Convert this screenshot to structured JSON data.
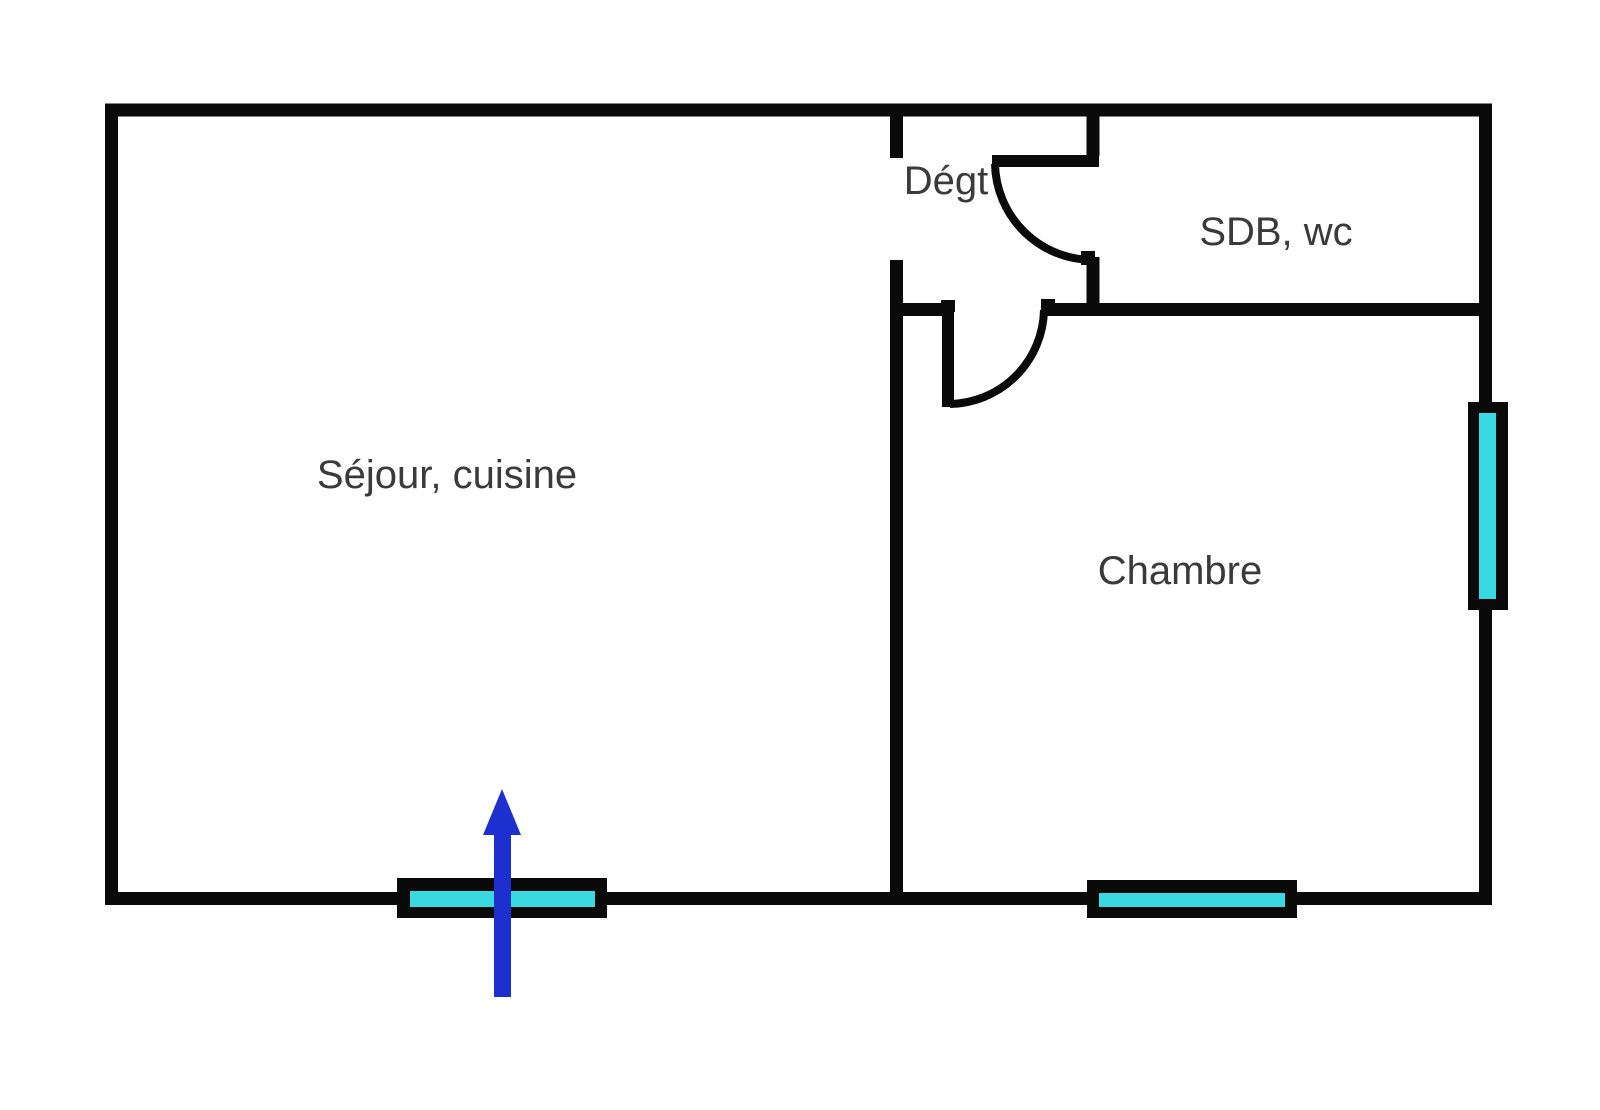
{
  "floor_plan": {
    "rooms": [
      {
        "id": "sejour-cuisine",
        "label": "Séjour, cuisine"
      },
      {
        "id": "degagement",
        "label": "Dégt"
      },
      {
        "id": "sdb-wc",
        "label": "SDB, wc"
      },
      {
        "id": "chambre",
        "label": "Chambre"
      }
    ],
    "doors": [
      {
        "id": "sdb-door",
        "between": "degagement / sdb-wc",
        "swing": "quarter-arc"
      },
      {
        "id": "chambre-door",
        "between": "degagement / chambre",
        "swing": "quarter-arc"
      }
    ],
    "windows": [
      {
        "id": "sejour-south-window",
        "wall": "bottom",
        "room": "sejour-cuisine"
      },
      {
        "id": "chambre-south-window",
        "wall": "bottom",
        "room": "chambre"
      },
      {
        "id": "chambre-east-window",
        "wall": "right",
        "room": "chambre"
      }
    ],
    "entrance": {
      "id": "entrance-arrow",
      "direction": "up",
      "through": "sejour-south-window"
    }
  },
  "colors": {
    "background": "#ffffff",
    "wall": "#0a0a0a",
    "window_glass": "#38d9e0",
    "entrance_arrow": "#1e2fd0",
    "label_text": "#3a3a3a"
  }
}
